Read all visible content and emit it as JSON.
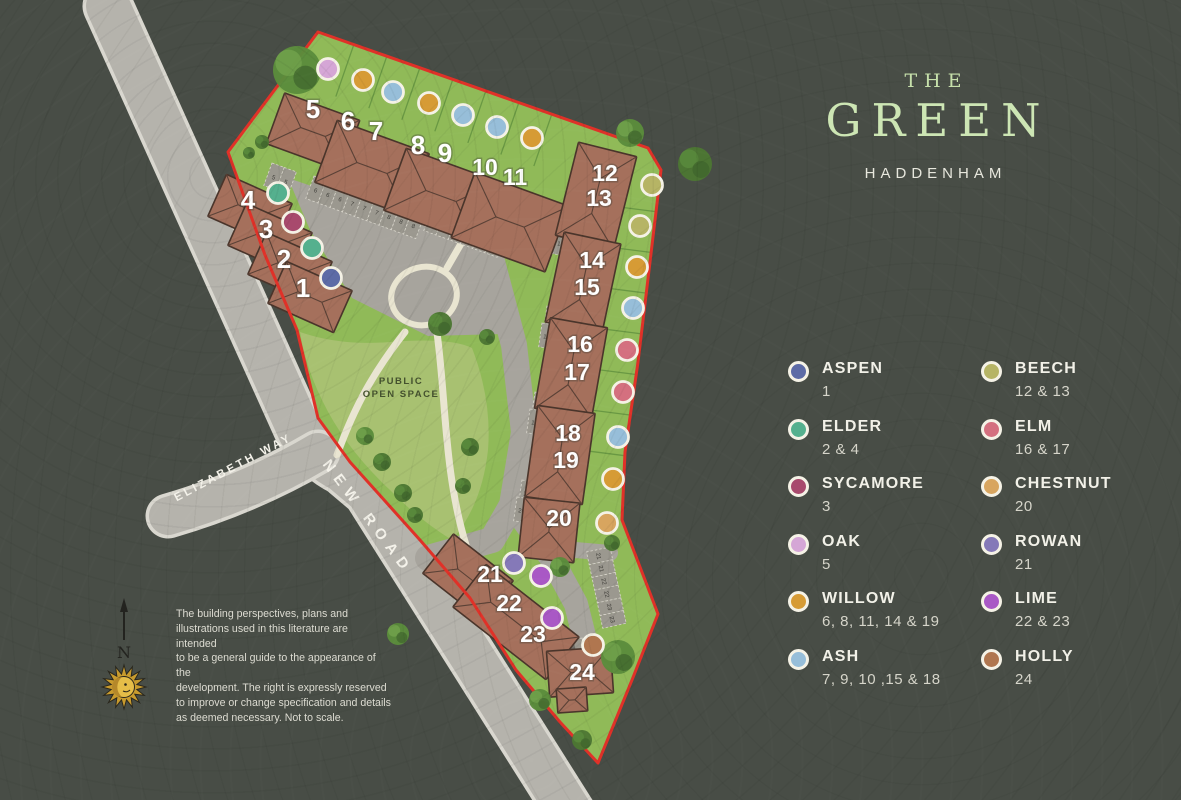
{
  "title": {
    "line1": "THE",
    "line2": "GREEN",
    "location": "HADDENHAM"
  },
  "legend": {
    "columns": [
      {
        "items": [
          {
            "name": "ASPEN",
            "plots": "1",
            "species": "aspen"
          },
          {
            "name": "ELDER",
            "plots": "2 & 4",
            "species": "elder"
          },
          {
            "name": "SYCAMORE",
            "plots": "3",
            "species": "sycamore"
          },
          {
            "name": "OAK",
            "plots": "5",
            "species": "oak"
          },
          {
            "name": "WILLOW",
            "plots": "6, 8, 11, 14 & 19",
            "species": "willow"
          },
          {
            "name": "ASH",
            "plots": "7, 9, 10 ,15 & 18",
            "species": "ash"
          }
        ]
      },
      {
        "items": [
          {
            "name": "BEECH",
            "plots": "12 & 13",
            "species": "beech"
          },
          {
            "name": "ELM",
            "plots": "16 & 17",
            "species": "elm"
          },
          {
            "name": "CHESTNUT",
            "plots": "20",
            "species": "chestnut"
          },
          {
            "name": "ROWAN",
            "plots": "21",
            "species": "rowan"
          },
          {
            "name": "LIME",
            "plots": "22 & 23",
            "species": "lime"
          },
          {
            "name": "HOLLY",
            "plots": "24",
            "species": "holly"
          }
        ]
      }
    ]
  },
  "species_colors": {
    "aspen": "#5d6ba6",
    "elder": "#55b08e",
    "sycamore": "#a84a6d",
    "oak": "#d5a6d6",
    "willow": "#d69b35",
    "ash": "#97bed9",
    "beech": "#b6b465",
    "elm": "#d4707f",
    "chestnut": "#d8a55f",
    "rowan": "#8579b8",
    "lime": "#a958c5",
    "holly": "#b0764f"
  },
  "map": {
    "roads": {
      "new_road": "NEW ROAD",
      "elizabeth_way": "ELIZABETH WAY"
    },
    "open_space": {
      "line1": "PUBLIC",
      "line2": "OPEN SPACE"
    },
    "compass": {
      "north": "N"
    },
    "plots": [
      {
        "number": "1",
        "species": "aspen"
      },
      {
        "number": "2",
        "species": "elder"
      },
      {
        "number": "3",
        "species": "sycamore"
      },
      {
        "number": "4",
        "species": "elder"
      },
      {
        "number": "5",
        "species": "oak"
      },
      {
        "number": "6",
        "species": "willow"
      },
      {
        "number": "7",
        "species": "ash"
      },
      {
        "number": "8",
        "species": "willow"
      },
      {
        "number": "9",
        "species": "ash"
      },
      {
        "number": "10",
        "species": "ash"
      },
      {
        "number": "11",
        "species": "willow"
      },
      {
        "number": "12",
        "species": "beech"
      },
      {
        "number": "13",
        "species": "beech"
      },
      {
        "number": "14",
        "species": "willow"
      },
      {
        "number": "15",
        "species": "ash"
      },
      {
        "number": "16",
        "species": "elm"
      },
      {
        "number": "17",
        "species": "elm"
      },
      {
        "number": "18",
        "species": "ash"
      },
      {
        "number": "19",
        "species": "willow"
      },
      {
        "number": "20",
        "species": "chestnut"
      },
      {
        "number": "21",
        "species": "rowan"
      },
      {
        "number": "22",
        "species": "lime"
      },
      {
        "number": "23",
        "species": "lime"
      },
      {
        "number": "24",
        "species": "holly"
      }
    ],
    "parking_rows": [
      [
        "5",
        "5"
      ],
      [
        "6",
        "6",
        "6",
        "7",
        "7",
        "7",
        "8",
        "8",
        "8"
      ],
      [
        "9",
        "9",
        "10",
        "10",
        "11",
        "11"
      ],
      [
        "12",
        "12"
      ],
      [
        "13",
        "13"
      ],
      [
        "14",
        "14"
      ],
      [
        "15",
        "15"
      ],
      [
        "16",
        "16"
      ],
      [
        "17",
        "17"
      ],
      [
        "18",
        "18"
      ],
      [
        "19",
        "19"
      ],
      [
        "20",
        "20"
      ],
      [
        "21",
        "21",
        "22",
        "22",
        "23",
        "23"
      ],
      [
        "24"
      ]
    ]
  },
  "disclaimer": {
    "lines": [
      "The building perspectives, plans and",
      "illustrations used in this literature are intended",
      "to be a general guide to the appearance of the",
      "development. The right is expressly reserved",
      "to improve or change specification and details",
      "as deemed necessary. Not to scale."
    ]
  },
  "colors": {
    "background": "#484d46",
    "title_green": "#cde6b4",
    "text_light": "#f2f1e8",
    "text_muted": "#d6d5ca",
    "boundary_red": "#e03128",
    "grass": "#90ba58",
    "open_space_green": "#a8c171",
    "road": "#b5b3ac",
    "road_edge": "#d9d7cf",
    "parking": "#a7a49d",
    "stall": "#9b988f",
    "building": "#a5705c",
    "building_outline": "#4a352b",
    "tree_green": "#4c7733",
    "path_cream": "#e9e5d1",
    "dot_ring": "#f5f2e6",
    "plot_number_text": "#ffffff",
    "open_space_text": "#44512e",
    "road_label_text": "#f4f2ea"
  }
}
